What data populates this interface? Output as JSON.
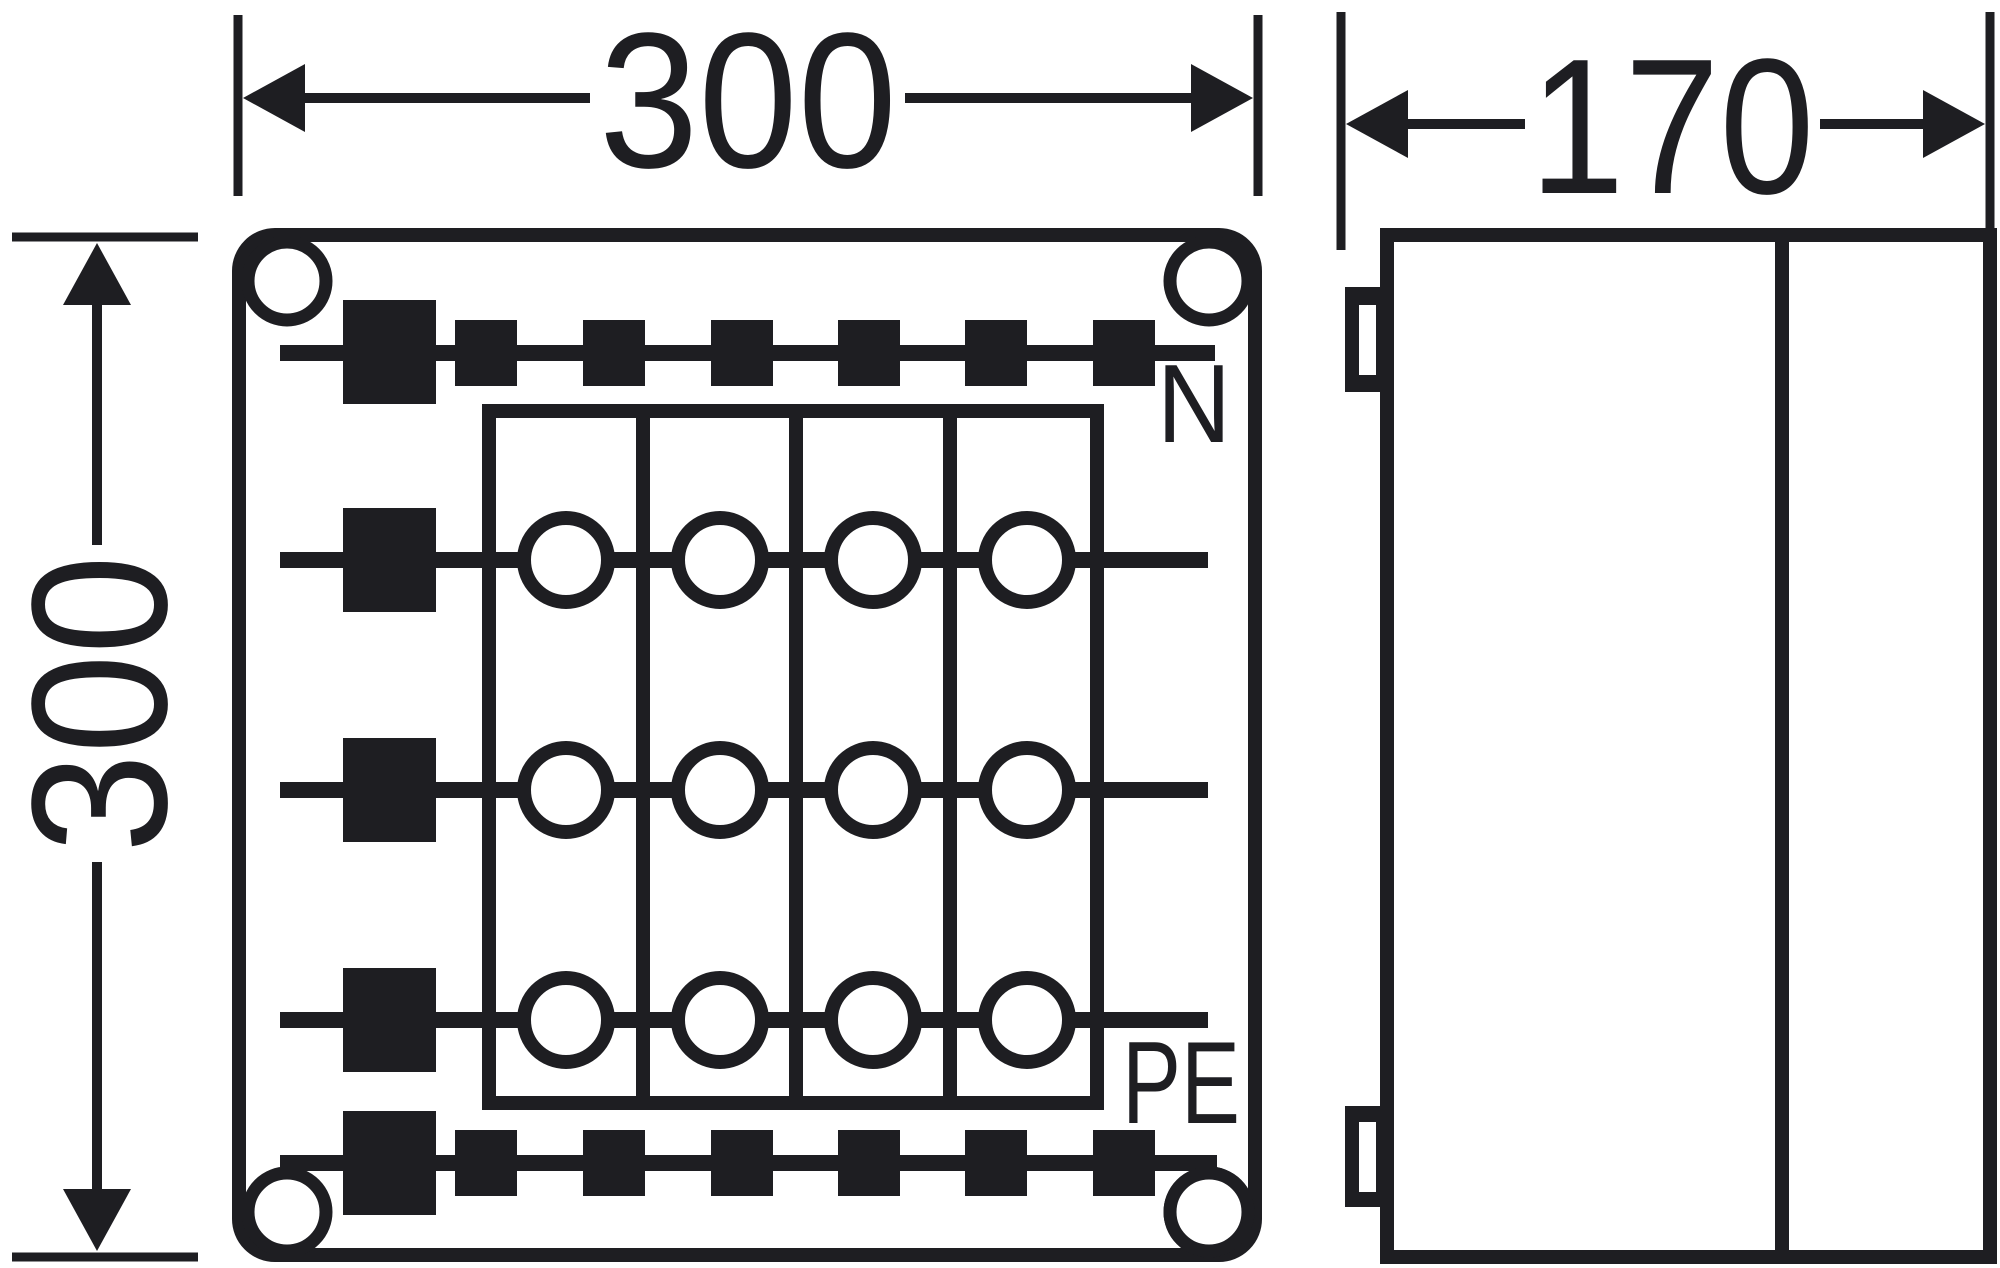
{
  "colors": {
    "ink": "#1e1e22",
    "background": "#ffffff"
  },
  "dimensions": {
    "front_width": "300",
    "front_height": "300",
    "side_depth": "170"
  },
  "labels": {
    "neutral": "N",
    "earth": "PE"
  },
  "front_view": {
    "corner_holes": 4,
    "terminal_rows": 3,
    "terminal_columns": 4,
    "n_bus_small_squares": 6,
    "pe_bus_small_squares": 6,
    "cable_entry_squares": 5
  },
  "side_view": {
    "mounting_clips": 2,
    "panels": 2
  }
}
